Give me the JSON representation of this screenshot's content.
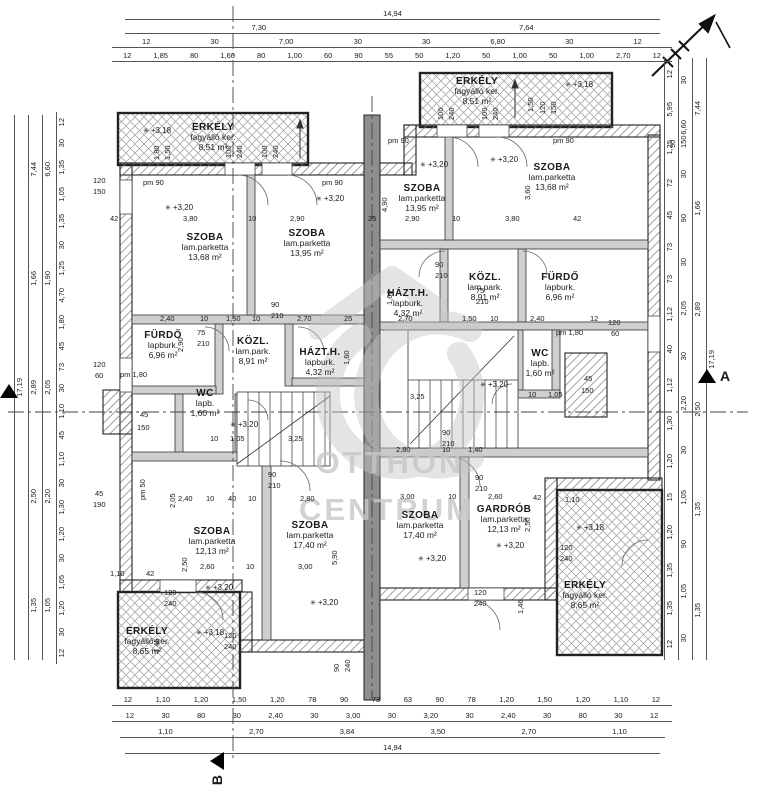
{
  "watermark": {
    "line1": "OTTHON",
    "line2": "CENTRUM"
  },
  "markers": {
    "left_section": {
      "label": ""
    },
    "right_section": {
      "label": "A"
    },
    "bottom_section": {
      "label": "B"
    }
  },
  "colors": {
    "wall_hatch": "#777777",
    "party_wall": "#8e8e8e",
    "watermark": "#c7c7c7",
    "line": "#222222"
  },
  "rooms": [
    {
      "name": "ERKÉLY",
      "finish": "fagyálló ker.",
      "area": "8,51 m²",
      "x": 213,
      "y": 122
    },
    {
      "name": "SZOBA",
      "finish": "lam.parketta",
      "area": "13,68 m²",
      "x": 205,
      "y": 232
    },
    {
      "name": "SZOBA",
      "finish": "lam.parketta",
      "area": "13,95 m²",
      "x": 307,
      "y": 228
    },
    {
      "name": "FÜRDŐ",
      "finish": "lapburk.",
      "area": "6,96 m²",
      "x": 163,
      "y": 330
    },
    {
      "name": "KÖZL.",
      "finish": "lam.park.",
      "area": "8,91 m²",
      "x": 253,
      "y": 336
    },
    {
      "name": "HÁZT.H.",
      "finish": "lapburk.",
      "area": "4,32 m²",
      "x": 320,
      "y": 347
    },
    {
      "name": "WC",
      "finish": "lapb.",
      "area": "1,60 m²",
      "x": 205,
      "y": 388
    },
    {
      "name": "SZOBA",
      "finish": "lam.parketta",
      "area": "12,13 m²",
      "x": 212,
      "y": 526
    },
    {
      "name": "SZOBA",
      "finish": "lam.parketta",
      "area": "17,40 m²",
      "x": 310,
      "y": 520
    },
    {
      "name": "ERKÉLY",
      "finish": "fagyálló ker.",
      "area": "8,65 m²",
      "x": 147,
      "y": 626
    },
    {
      "name": "ERKÉLY",
      "finish": "fagyálló ker.",
      "area": "8,51 m²",
      "x": 477,
      "y": 76
    },
    {
      "name": "SZOBA",
      "finish": "lam.parketta",
      "area": "13,95 m²",
      "x": 422,
      "y": 183
    },
    {
      "name": "SZOBA",
      "finish": "lam.parketta",
      "area": "13,68 m²",
      "x": 552,
      "y": 162
    },
    {
      "name": "HÁZT.H.",
      "finish": "lapburk.",
      "area": "4,32 m²",
      "x": 408,
      "y": 288
    },
    {
      "name": "KÖZL.",
      "finish": "lam.park.",
      "area": "8,91 m²",
      "x": 485,
      "y": 272
    },
    {
      "name": "FÜRDŐ",
      "finish": "lapburk.",
      "area": "6,96 m²",
      "x": 560,
      "y": 272
    },
    {
      "name": "WC",
      "finish": "lapb.",
      "area": "1,60 m²",
      "x": 540,
      "y": 348
    },
    {
      "name": "SZOBA",
      "finish": "lam.parketta",
      "area": "17,40 m²",
      "x": 420,
      "y": 510
    },
    {
      "name": "GARDRÓB",
      "finish": "lam.parketta",
      "area": "12,13 m²",
      "x": 504,
      "y": 504
    },
    {
      "name": "ERKÉLY",
      "finish": "fagyálló ker.",
      "area": "8,65 m²",
      "x": 585,
      "y": 580
    }
  ],
  "h_dims": [
    {
      "x": 125,
      "y": 8,
      "w": 535,
      "values": [
        "14,94"
      ]
    },
    {
      "x": 125,
      "y": 22,
      "w": 535,
      "values": [
        "7,30",
        "7,64"
      ]
    },
    {
      "x": 112,
      "y": 36,
      "w": 560,
      "values": [
        "12",
        "30",
        "7,00",
        "30",
        "30",
        "6,80",
        "30",
        "12"
      ]
    },
    {
      "x": 112,
      "y": 50,
      "w": 560,
      "values": [
        "12",
        "1,85",
        "80",
        "1,60",
        "80",
        "1,00",
        "60",
        "90",
        "55",
        "50",
        "1,20",
        "50",
        "1,00",
        "50",
        "1,00",
        "2,70",
        "12"
      ]
    },
    {
      "x": 112,
      "y": 694,
      "w": 560,
      "values": [
        "12",
        "1,10",
        "1,20",
        "1,50",
        "1,20",
        "78",
        "90",
        "73",
        "63",
        "90",
        "78",
        "1,20",
        "1,50",
        "1,20",
        "1,10",
        "12"
      ]
    },
    {
      "x": 112,
      "y": 710,
      "w": 560,
      "values": [
        "12",
        "30",
        "80",
        "30",
        "2,40",
        "30",
        "3,00",
        "30",
        "3,20",
        "30",
        "2,40",
        "30",
        "80",
        "30",
        "12"
      ]
    },
    {
      "x": 120,
      "y": 726,
      "w": 545,
      "values": [
        "1,10",
        "2,70",
        "3,84",
        "3,50",
        "2,70",
        "1,10"
      ]
    },
    {
      "x": 125,
      "y": 742,
      "w": 535,
      "values": [
        "14,94"
      ]
    }
  ],
  "v_dims": [
    {
      "x": 14,
      "y": 115,
      "h": 545,
      "values": [
        "17,19"
      ]
    },
    {
      "x": 28,
      "y": 115,
      "h": 545,
      "values": [
        "7,44",
        "1,66",
        "2,89",
        "2,50",
        "1,35"
      ]
    },
    {
      "x": 42,
      "y": 115,
      "h": 545,
      "values": [
        "6,60",
        "1,90",
        "2,05",
        "2,20",
        "1,05"
      ]
    },
    {
      "x": 56,
      "y": 112,
      "h": 552,
      "values": [
        "12",
        "30",
        "1,35",
        "1,05",
        "1,35",
        "30",
        "1,25",
        "4,70",
        "1,80",
        "45",
        "73",
        "30",
        "1,10",
        "45",
        "1,10",
        "30",
        "1,30",
        "1,20",
        "30",
        "1,05",
        "1,20",
        "30",
        "12"
      ]
    },
    {
      "x": 664,
      "y": 58,
      "h": 602,
      "values": [
        "12",
        "5,95",
        "1,25",
        "72",
        "45",
        "73",
        "73",
        "1,12",
        "40",
        "1,12",
        "1,30",
        "1,20",
        "15",
        "1,20",
        "1,35",
        "1,35",
        "12"
      ]
    },
    {
      "x": 678,
      "y": 58,
      "h": 602,
      "values": [
        "30",
        "6,60",
        "30",
        "90",
        "30",
        "2,05",
        "30",
        "2,20",
        "30",
        "1,05",
        "90",
        "1,05",
        "30"
      ]
    },
    {
      "x": 692,
      "y": 58,
      "h": 602,
      "values": [
        "7,44",
        "1,66",
        "2,89",
        "2,50",
        "1,35",
        "1,35"
      ]
    },
    {
      "x": 706,
      "y": 58,
      "h": 602,
      "values": [
        "17,19"
      ]
    }
  ],
  "annotations": [
    {
      "t": "3,80",
      "x": 183,
      "y": 214
    },
    {
      "t": "10",
      "x": 248,
      "y": 214
    },
    {
      "t": "2,90",
      "x": 290,
      "y": 214
    },
    {
      "t": "42",
      "x": 110,
      "y": 214
    },
    {
      "t": "25",
      "x": 368,
      "y": 214
    },
    {
      "t": "2,90",
      "x": 405,
      "y": 214
    },
    {
      "t": "10",
      "x": 452,
      "y": 214
    },
    {
      "t": "3,80",
      "x": 505,
      "y": 214
    },
    {
      "t": "42",
      "x": 573,
      "y": 214
    },
    {
      "t": "4,90",
      "x": 380,
      "y": 212,
      "r": -90
    },
    {
      "t": "3,60",
      "x": 523,
      "y": 200,
      "r": -90
    },
    {
      "t": "2,40",
      "x": 160,
      "y": 314
    },
    {
      "t": "10",
      "x": 200,
      "y": 314
    },
    {
      "t": "1,50",
      "x": 226,
      "y": 314
    },
    {
      "t": "10",
      "x": 252,
      "y": 314
    },
    {
      "t": "2,70",
      "x": 297,
      "y": 314
    },
    {
      "t": "25",
      "x": 344,
      "y": 314
    },
    {
      "t": "2,70",
      "x": 398,
      "y": 314
    },
    {
      "t": "1,50",
      "x": 462,
      "y": 314
    },
    {
      "t": "10",
      "x": 490,
      "y": 314
    },
    {
      "t": "2,40",
      "x": 530,
      "y": 314
    },
    {
      "t": "12",
      "x": 590,
      "y": 314
    },
    {
      "t": "2,90",
      "x": 176,
      "y": 352,
      "r": -90
    },
    {
      "t": "1,60",
      "x": 342,
      "y": 365,
      "r": -90
    },
    {
      "t": "1,60",
      "x": 385,
      "y": 305,
      "r": -90
    },
    {
      "t": "3,25",
      "x": 288,
      "y": 434
    },
    {
      "t": "1,05",
      "x": 230,
      "y": 434
    },
    {
      "t": "10",
      "x": 210,
      "y": 434
    },
    {
      "t": "3,25",
      "x": 410,
      "y": 392
    },
    {
      "t": "1,05",
      "x": 548,
      "y": 390
    },
    {
      "t": "10",
      "x": 528,
      "y": 390
    },
    {
      "t": "2,40",
      "x": 178,
      "y": 494
    },
    {
      "t": "10",
      "x": 206,
      "y": 494
    },
    {
      "t": "40",
      "x": 228,
      "y": 494
    },
    {
      "t": "10",
      "x": 248,
      "y": 494
    },
    {
      "t": "2,80",
      "x": 300,
      "y": 494
    },
    {
      "t": "2,05",
      "x": 168,
      "y": 508,
      "r": -90
    },
    {
      "t": "2,80",
      "x": 396,
      "y": 445
    },
    {
      "t": "10",
      "x": 442,
      "y": 445
    },
    {
      "t": "1,40",
      "x": 468,
      "y": 445
    },
    {
      "t": "2,60",
      "x": 200,
      "y": 562
    },
    {
      "t": "10",
      "x": 246,
      "y": 562
    },
    {
      "t": "3,00",
      "x": 298,
      "y": 562
    },
    {
      "t": "5,90",
      "x": 330,
      "y": 565,
      "r": -90
    },
    {
      "t": "2,50",
      "x": 180,
      "y": 572,
      "r": -90
    },
    {
      "t": "3,00",
      "x": 400,
      "y": 492
    },
    {
      "t": "10",
      "x": 448,
      "y": 492
    },
    {
      "t": "2,60",
      "x": 488,
      "y": 492
    },
    {
      "t": "42",
      "x": 533,
      "y": 493
    },
    {
      "t": "1,10",
      "x": 565,
      "y": 495
    },
    {
      "t": "2,50",
      "x": 523,
      "y": 532,
      "r": -90
    },
    {
      "t": "1,46",
      "x": 516,
      "y": 614,
      "r": -90
    },
    {
      "t": "1,45",
      "x": 152,
      "y": 653,
      "r": -90
    },
    {
      "t": "1,10",
      "x": 110,
      "y": 569
    },
    {
      "t": "42",
      "x": 146,
      "y": 569
    },
    {
      "t": "+3,18",
      "x": 143,
      "y": 126,
      "c": "level"
    },
    {
      "t": "+3,20",
      "x": 165,
      "y": 203,
      "c": "level"
    },
    {
      "t": "+3,20",
      "x": 316,
      "y": 194,
      "c": "level"
    },
    {
      "t": "+3,18",
      "x": 565,
      "y": 80,
      "c": "level"
    },
    {
      "t": "+3,20",
      "x": 420,
      "y": 160,
      "c": "level"
    },
    {
      "t": "+3,20",
      "x": 490,
      "y": 155,
      "c": "level"
    },
    {
      "t": "+3,20",
      "x": 230,
      "y": 420,
      "c": "level"
    },
    {
      "t": "+3,20",
      "x": 480,
      "y": 380,
      "c": "level"
    },
    {
      "t": "+3,20",
      "x": 205,
      "y": 583,
      "c": "level"
    },
    {
      "t": "+3,20",
      "x": 310,
      "y": 598,
      "c": "level"
    },
    {
      "t": "+3,18",
      "x": 196,
      "y": 628,
      "c": "level"
    },
    {
      "t": "+3,20",
      "x": 418,
      "y": 554,
      "c": "level"
    },
    {
      "t": "+3,20",
      "x": 496,
      "y": 541,
      "c": "level"
    },
    {
      "t": "+3,18",
      "x": 576,
      "y": 523,
      "c": "level"
    },
    {
      "t": "pm 90",
      "x": 143,
      "y": 178
    },
    {
      "t": "pm 90",
      "x": 322,
      "y": 178
    },
    {
      "t": "pm 90",
      "x": 388,
      "y": 136
    },
    {
      "t": "pm 90",
      "x": 553,
      "y": 136
    },
    {
      "t": "pm 1,80",
      "x": 120,
      "y": 370
    },
    {
      "t": "pm 1,80",
      "x": 556,
      "y": 328
    },
    {
      "t": "pm 50",
      "x": 138,
      "y": 500,
      "r": -90
    },
    {
      "t": "120",
      "x": 93,
      "y": 176
    },
    {
      "t": "150",
      "x": 93,
      "y": 187
    },
    {
      "t": "120",
      "x": 93,
      "y": 360
    },
    {
      "t": "60",
      "x": 95,
      "y": 371
    },
    {
      "t": "45",
      "x": 95,
      "y": 489
    },
    {
      "t": "190",
      "x": 93,
      "y": 500
    },
    {
      "t": "120",
      "x": 608,
      "y": 318
    },
    {
      "t": "60",
      "x": 611,
      "y": 329
    },
    {
      "t": "45",
      "x": 584,
      "y": 374
    },
    {
      "t": "150",
      "x": 581,
      "y": 386
    },
    {
      "t": "45",
      "x": 140,
      "y": 410
    },
    {
      "t": "150",
      "x": 137,
      "y": 423
    },
    {
      "t": "100",
      "x": 224,
      "y": 158,
      "r": -90
    },
    {
      "t": "240",
      "x": 235,
      "y": 158,
      "r": -90
    },
    {
      "t": "100",
      "x": 260,
      "y": 158,
      "r": -90
    },
    {
      "t": "240",
      "x": 271,
      "y": 158,
      "r": -90
    },
    {
      "t": "1,80",
      "x": 152,
      "y": 160,
      "r": -90
    },
    {
      "t": "1,50",
      "x": 163,
      "y": 160,
      "r": -90
    },
    {
      "t": "100",
      "x": 436,
      "y": 120,
      "r": -90
    },
    {
      "t": "240",
      "x": 447,
      "y": 120,
      "r": -90
    },
    {
      "t": "100",
      "x": 480,
      "y": 120,
      "r": -90
    },
    {
      "t": "240",
      "x": 491,
      "y": 120,
      "r": -90
    },
    {
      "t": "1,50",
      "x": 526,
      "y": 112,
      "r": -90
    },
    {
      "t": "120",
      "x": 538,
      "y": 114,
      "r": -90
    },
    {
      "t": "150",
      "x": 549,
      "y": 114,
      "r": -90
    },
    {
      "t": "90",
      "x": 668,
      "y": 148,
      "r": -90
    },
    {
      "t": "150",
      "x": 679,
      "y": 148,
      "r": -90
    },
    {
      "t": "75",
      "x": 197,
      "y": 328
    },
    {
      "t": "210",
      "x": 197,
      "y": 339
    },
    {
      "t": "90",
      "x": 271,
      "y": 300
    },
    {
      "t": "210",
      "x": 271,
      "y": 311
    },
    {
      "t": "90",
      "x": 435,
      "y": 260
    },
    {
      "t": "210",
      "x": 435,
      "y": 271
    },
    {
      "t": "75",
      "x": 476,
      "y": 286
    },
    {
      "t": "210",
      "x": 476,
      "y": 297
    },
    {
      "t": "90",
      "x": 268,
      "y": 470
    },
    {
      "t": "210",
      "x": 268,
      "y": 481
    },
    {
      "t": "90",
      "x": 442,
      "y": 428
    },
    {
      "t": "210",
      "x": 442,
      "y": 439
    },
    {
      "t": "90",
      "x": 475,
      "y": 473
    },
    {
      "t": "210",
      "x": 475,
      "y": 484
    },
    {
      "t": "120",
      "x": 164,
      "y": 588
    },
    {
      "t": "240",
      "x": 164,
      "y": 599
    },
    {
      "t": "120",
      "x": 224,
      "y": 631
    },
    {
      "t": "240",
      "x": 224,
      "y": 642
    },
    {
      "t": "120",
      "x": 474,
      "y": 588
    },
    {
      "t": "240",
      "x": 474,
      "y": 599
    },
    {
      "t": "120",
      "x": 560,
      "y": 543
    },
    {
      "t": "240",
      "x": 560,
      "y": 554
    },
    {
      "t": "90",
      "x": 332,
      "y": 672,
      "r": -90
    },
    {
      "t": "240",
      "x": 343,
      "y": 672,
      "r": -90
    }
  ]
}
